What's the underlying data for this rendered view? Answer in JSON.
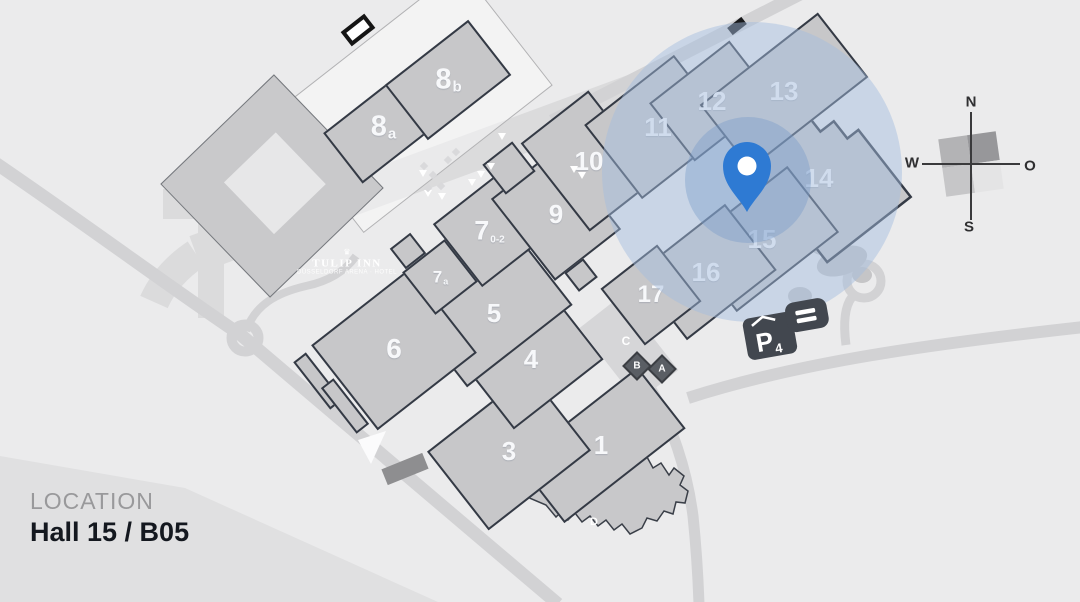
{
  "location": {
    "label": "LOCATION",
    "value": "Hall 15 / B05"
  },
  "compass": {
    "n": "N",
    "w": "W",
    "o": "O",
    "s": "S"
  },
  "hotel": {
    "logo": "♛",
    "name": "TULIP INN",
    "tagline": "DÜSSELDORF ARENA · HOTEL"
  },
  "parking": {
    "letter": "P",
    "number": "4"
  },
  "entrances": {
    "a": "A",
    "b": "B",
    "c": "C",
    "d": "D"
  },
  "halls": [
    {
      "id": "1",
      "label": "1",
      "sub": ""
    },
    {
      "id": "3",
      "label": "3",
      "sub": ""
    },
    {
      "id": "4",
      "label": "4",
      "sub": ""
    },
    {
      "id": "5",
      "label": "5",
      "sub": ""
    },
    {
      "id": "6",
      "label": "6",
      "sub": ""
    },
    {
      "id": "7",
      "label": "7",
      "sub": "0-2"
    },
    {
      "id": "7a",
      "label": "7",
      "sub": "a"
    },
    {
      "id": "8a",
      "label": "8",
      "sub": "a"
    },
    {
      "id": "8b",
      "label": "8",
      "sub": "b"
    },
    {
      "id": "9",
      "label": "9",
      "sub": ""
    },
    {
      "id": "10",
      "label": "10",
      "sub": ""
    },
    {
      "id": "11",
      "label": "11",
      "sub": ""
    },
    {
      "id": "12",
      "label": "12",
      "sub": ""
    },
    {
      "id": "13",
      "label": "13",
      "sub": ""
    },
    {
      "id": "14",
      "label": "14",
      "sub": ""
    },
    {
      "id": "15",
      "label": "15",
      "sub": ""
    },
    {
      "id": "16",
      "label": "16",
      "sub": ""
    },
    {
      "id": "17",
      "label": "17",
      "sub": ""
    }
  ],
  "pin": {
    "marked_hall": "15",
    "marked_stand": "B05"
  },
  "colors": {
    "background": "#ebebec",
    "road": "#d2d2d4",
    "hall_fill": "#c7c7c9",
    "hall_outline": "#343a45",
    "highlight_blue": "#a3bedf",
    "pin_blue": "#2e7ad3",
    "dark_icon": "#42474f"
  }
}
